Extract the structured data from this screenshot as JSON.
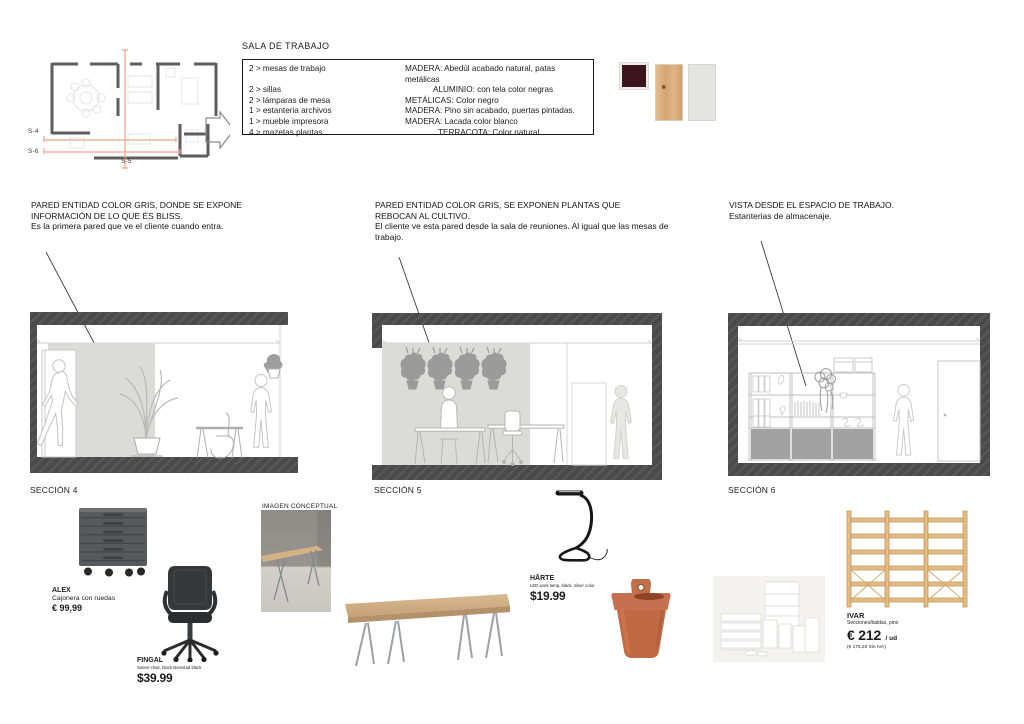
{
  "plan": {
    "s4": "S-4",
    "s5": "S-5",
    "s6": "S-6"
  },
  "spec": {
    "title": "SALA DE TRABAJO",
    "rows": [
      {
        "qty": "2 > mesas de trabajo",
        "material": "MADERA: Abedúl acabado natural, patas metálicas"
      },
      {
        "qty": "2 > sillas",
        "material": "ALUMINIO: con tela color negras"
      },
      {
        "qty": "2 > lámparas de mesa",
        "material": "METÁLICAS: Color negro"
      },
      {
        "qty": "1 > estanteria archivos",
        "material": "MADERA: Pino sin acabado, puertas pintadas."
      },
      {
        "qty": "1 > mueble impresora",
        "material": "MADERA: Lacada color blanco"
      },
      {
        "qty": "4 > mazetas plantas",
        "material": "TERRACOTA: Color natural."
      }
    ]
  },
  "swatches": [
    {
      "name": "burgundy-panel",
      "color": "#3c1420"
    },
    {
      "name": "wood-panel",
      "color": "#d5a473"
    },
    {
      "name": "light-gray-panel",
      "color": "#e4e4e2"
    }
  ],
  "annotations": [
    {
      "heading": "PARED ENTIDAD COLOR GRIS, DONDE SE EXPONE INFORMACIÓN DE LO QUE ÉS BLISS.",
      "body": "Es la primera pared que ve el cliente cuando entra."
    },
    {
      "heading": "PARED ENTIDAD COLOR GRIS, SE EXPONEN PLANTAS QUE REBOCAN AL CULTIVO.",
      "body": "El cliente ve esta pared desde la sala de reuniones. Al igual que las mesas de trabajo."
    },
    {
      "heading": "VISTA DESDE EL ESPACIO DE TRABAJO.",
      "body": "Estanterias de almacenaje."
    }
  ],
  "sections": [
    {
      "label": "SECCIÓN 4"
    },
    {
      "label": "SECCIÓN 5"
    },
    {
      "label": "SECCIÓN 6"
    }
  ],
  "products": {
    "alex": {
      "name": "ALEX",
      "desc": "Cajonera con ruedas",
      "price": "€ 99,99"
    },
    "fingal": {
      "name": "FINGAL",
      "desc": "Swivel chair, black Bomstad black",
      "price": "$39.99"
    },
    "conceptual_label": "IMAGEN CONCEPTUAL",
    "harte": {
      "name": "HÅRTE",
      "desc": "LED work lamp, black, silver color",
      "price": "$19.99"
    },
    "ivar": {
      "name": "IVAR",
      "desc": "Secciones/baldas, pino",
      "price": "€ 212",
      "unit": "/ ud",
      "note": "(€ 175,20 Sin IVA)"
    }
  },
  "colors": {
    "section_line_orange": "#f0a489",
    "wall_dark": "#4a4a4a",
    "wall_gray_panel": "#dbdbd9",
    "terracotta": "#c06a45",
    "pine": "#dfb87e"
  }
}
